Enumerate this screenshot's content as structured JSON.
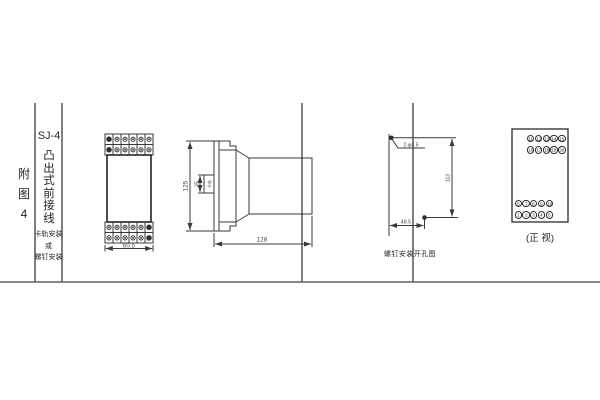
{
  "colors": {
    "background": "#ffffff",
    "drawing_line": "#3a3a3a",
    "frame_line": "#5f5f5f",
    "text": "#2b2b2b"
  },
  "sidebar": {
    "figure_label_chars": [
      "附",
      "图",
      "4"
    ],
    "model": "SJ-4",
    "title_chars": [
      "凸",
      "出",
      "式",
      "前",
      "接",
      "线"
    ],
    "mounting_lines": [
      "卡轨安装",
      "或",
      "螺钉安装"
    ]
  },
  "front_view": {
    "width_dim": "60.5"
  },
  "side_view": {
    "height_dim": "125",
    "clip_dim": "35",
    "clip_label": "卡轨",
    "depth_dim": "128"
  },
  "drill_view": {
    "holes_label": "2-φ4.5",
    "vertical_dim": "113",
    "horizontal_dim": "48.5",
    "caption": "螺钉安装开孔图"
  },
  "terminal_view": {
    "top_rows": [
      [
        "11",
        "12",
        "13",
        "14",
        "15"
      ],
      [
        "16",
        "17",
        "18",
        "19",
        "20"
      ]
    ],
    "bottom_rows": [
      [
        "6",
        "7",
        "8",
        "9",
        "10"
      ],
      [
        "1",
        "2",
        "3",
        "4",
        "5"
      ]
    ],
    "caption": "(正 视)"
  }
}
